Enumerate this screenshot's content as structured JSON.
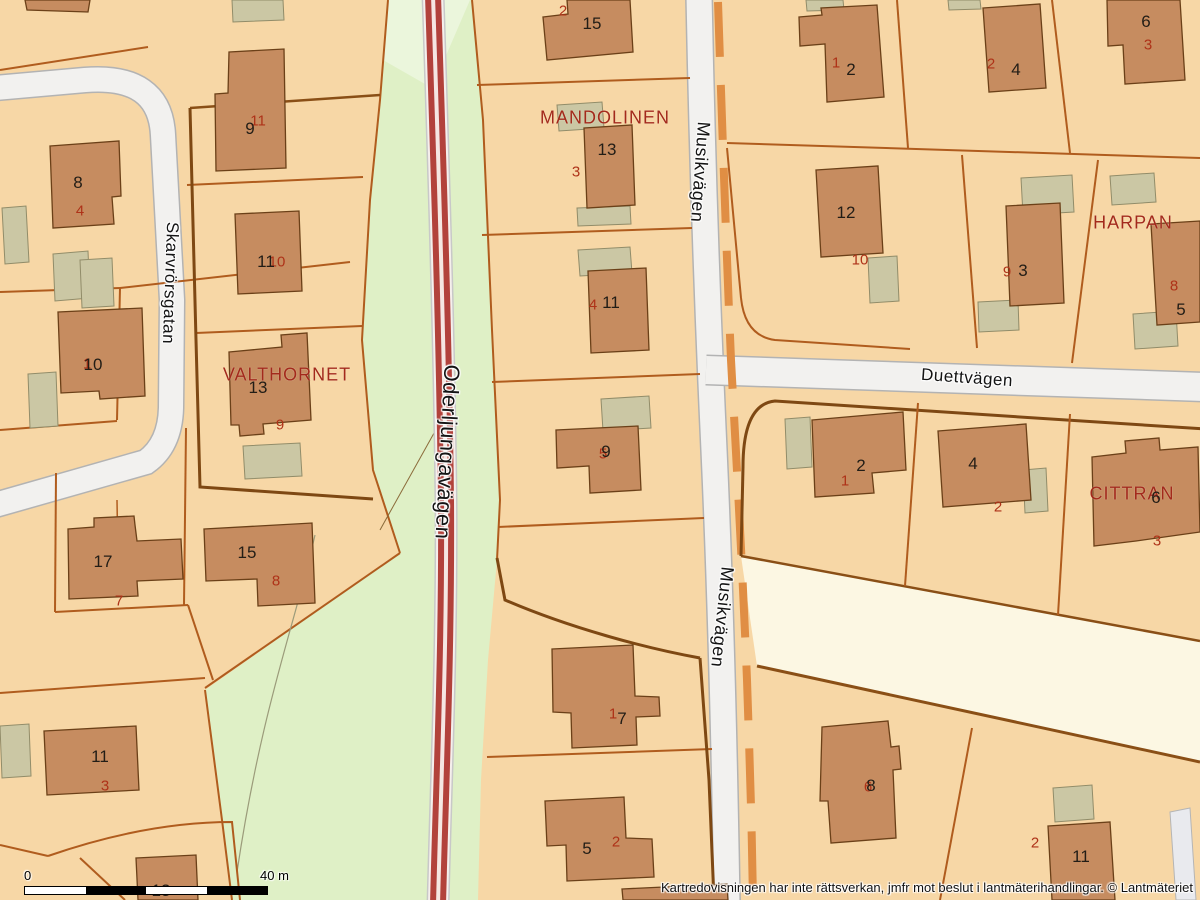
{
  "map": {
    "street_labels": [
      {
        "text": "Skarvrörsgatan",
        "x": 170,
        "y": 283,
        "rotate": 92,
        "size": 17
      },
      {
        "text": "Oderljungavägen",
        "x": 447,
        "y": 452,
        "rotate": 93,
        "size": 22
      },
      {
        "text": "Musikvägen",
        "x": 700,
        "y": 172,
        "rotate": 94,
        "size": 18
      },
      {
        "text": "Musikvägen",
        "x": 722,
        "y": 617,
        "rotate": 96,
        "size": 18
      },
      {
        "text": "Duettvägen",
        "x": 967,
        "y": 378,
        "rotate": 4,
        "size": 17
      }
    ],
    "block_labels": [
      {
        "text": "MANDOLINEN",
        "x": 605,
        "y": 118
      },
      {
        "text": "VALTHORNET",
        "x": 287,
        "y": 375
      },
      {
        "text": "HARPAN",
        "x": 1133,
        "y": 223
      },
      {
        "text": "CITTRAN",
        "x": 1132,
        "y": 494
      }
    ],
    "plot_numbers": [
      {
        "text": "15",
        "x": 592,
        "y": 24
      },
      {
        "text": "13",
        "x": 607,
        "y": 150
      },
      {
        "text": "11",
        "x": 611,
        "y": 303
      },
      {
        "text": "9",
        "x": 606,
        "y": 452
      },
      {
        "text": "7",
        "x": 622,
        "y": 719
      },
      {
        "text": "5",
        "x": 587,
        "y": 849
      },
      {
        "text": "9",
        "x": 250,
        "y": 129
      },
      {
        "text": "8",
        "x": 78,
        "y": 183
      },
      {
        "text": "11",
        "x": 266,
        "y": 262
      },
      {
        "text": "10",
        "x": 93,
        "y": 365
      },
      {
        "text": "13",
        "x": 258,
        "y": 388
      },
      {
        "text": "17",
        "x": 103,
        "y": 562
      },
      {
        "text": "15",
        "x": 247,
        "y": 553
      },
      {
        "text": "11",
        "x": 100,
        "y": 757
      },
      {
        "text": "13",
        "x": 161,
        "y": 891
      },
      {
        "text": "2",
        "x": 851,
        "y": 70
      },
      {
        "text": "4",
        "x": 1016,
        "y": 70
      },
      {
        "text": "6",
        "x": 1146,
        "y": 22
      },
      {
        "text": "12",
        "x": 846,
        "y": 213
      },
      {
        "text": "3",
        "x": 1023,
        "y": 271
      },
      {
        "text": "5",
        "x": 1181,
        "y": 310
      },
      {
        "text": "2",
        "x": 861,
        "y": 466
      },
      {
        "text": "4",
        "x": 973,
        "y": 464
      },
      {
        "text": "6",
        "x": 1156,
        "y": 498
      },
      {
        "text": "8",
        "x": 871,
        "y": 786
      },
      {
        "text": "11",
        "x": 1081,
        "y": 857
      }
    ],
    "address_numbers": [
      {
        "text": "2",
        "x": 563,
        "y": 11
      },
      {
        "text": "3",
        "x": 576,
        "y": 172
      },
      {
        "text": "4",
        "x": 593,
        "y": 305
      },
      {
        "text": "5",
        "x": 603,
        "y": 454
      },
      {
        "text": "1",
        "x": 613,
        "y": 714
      },
      {
        "text": "2",
        "x": 616,
        "y": 842
      },
      {
        "text": "11",
        "x": 258,
        "y": 121
      },
      {
        "text": "4",
        "x": 80,
        "y": 211
      },
      {
        "text": "10",
        "x": 277,
        "y": 262
      },
      {
        "text": "1",
        "x": 87,
        "y": 364
      },
      {
        "text": "9",
        "x": 280,
        "y": 425
      },
      {
        "text": "7",
        "x": 119,
        "y": 601
      },
      {
        "text": "8",
        "x": 276,
        "y": 581
      },
      {
        "text": "3",
        "x": 105,
        "y": 786
      },
      {
        "text": "1",
        "x": 836,
        "y": 63
      },
      {
        "text": "2",
        "x": 991,
        "y": 64
      },
      {
        "text": "3",
        "x": 1148,
        "y": 45
      },
      {
        "text": "10",
        "x": 860,
        "y": 260
      },
      {
        "text": "9",
        "x": 1007,
        "y": 272
      },
      {
        "text": "8",
        "x": 1174,
        "y": 286
      },
      {
        "text": "1",
        "x": 845,
        "y": 481
      },
      {
        "text": "2",
        "x": 998,
        "y": 507
      },
      {
        "text": "3",
        "x": 1157,
        "y": 541
      },
      {
        "text": "2",
        "x": 1035,
        "y": 843
      },
      {
        "text": "6",
        "x": 868,
        "y": 787
      }
    ]
  },
  "scalebar": {
    "start_label": "0",
    "end_label": "40 m"
  },
  "attribution": "Kartredovisningen har inte rättsverkan, jmfr mot beslut i lantmäterihandlingar. © Lantmäteriet",
  "colors": {
    "parcel": "#F7D7A6",
    "building": "#C68C60",
    "building_outline": "#6B4018",
    "shed": "#CBC7A4",
    "green_area": "#DFF0C6",
    "green_light": "#EBF6DC",
    "road_white": "#F2F1EF",
    "road_red": "#B2423B",
    "cream_strip": "#FCF7E3",
    "boundary": "#B05C1E",
    "boundary_thick": "#7E4813",
    "dash_orange": "#E08E44",
    "block_label": "#A32A1B",
    "address_number": "#AE3218"
  }
}
